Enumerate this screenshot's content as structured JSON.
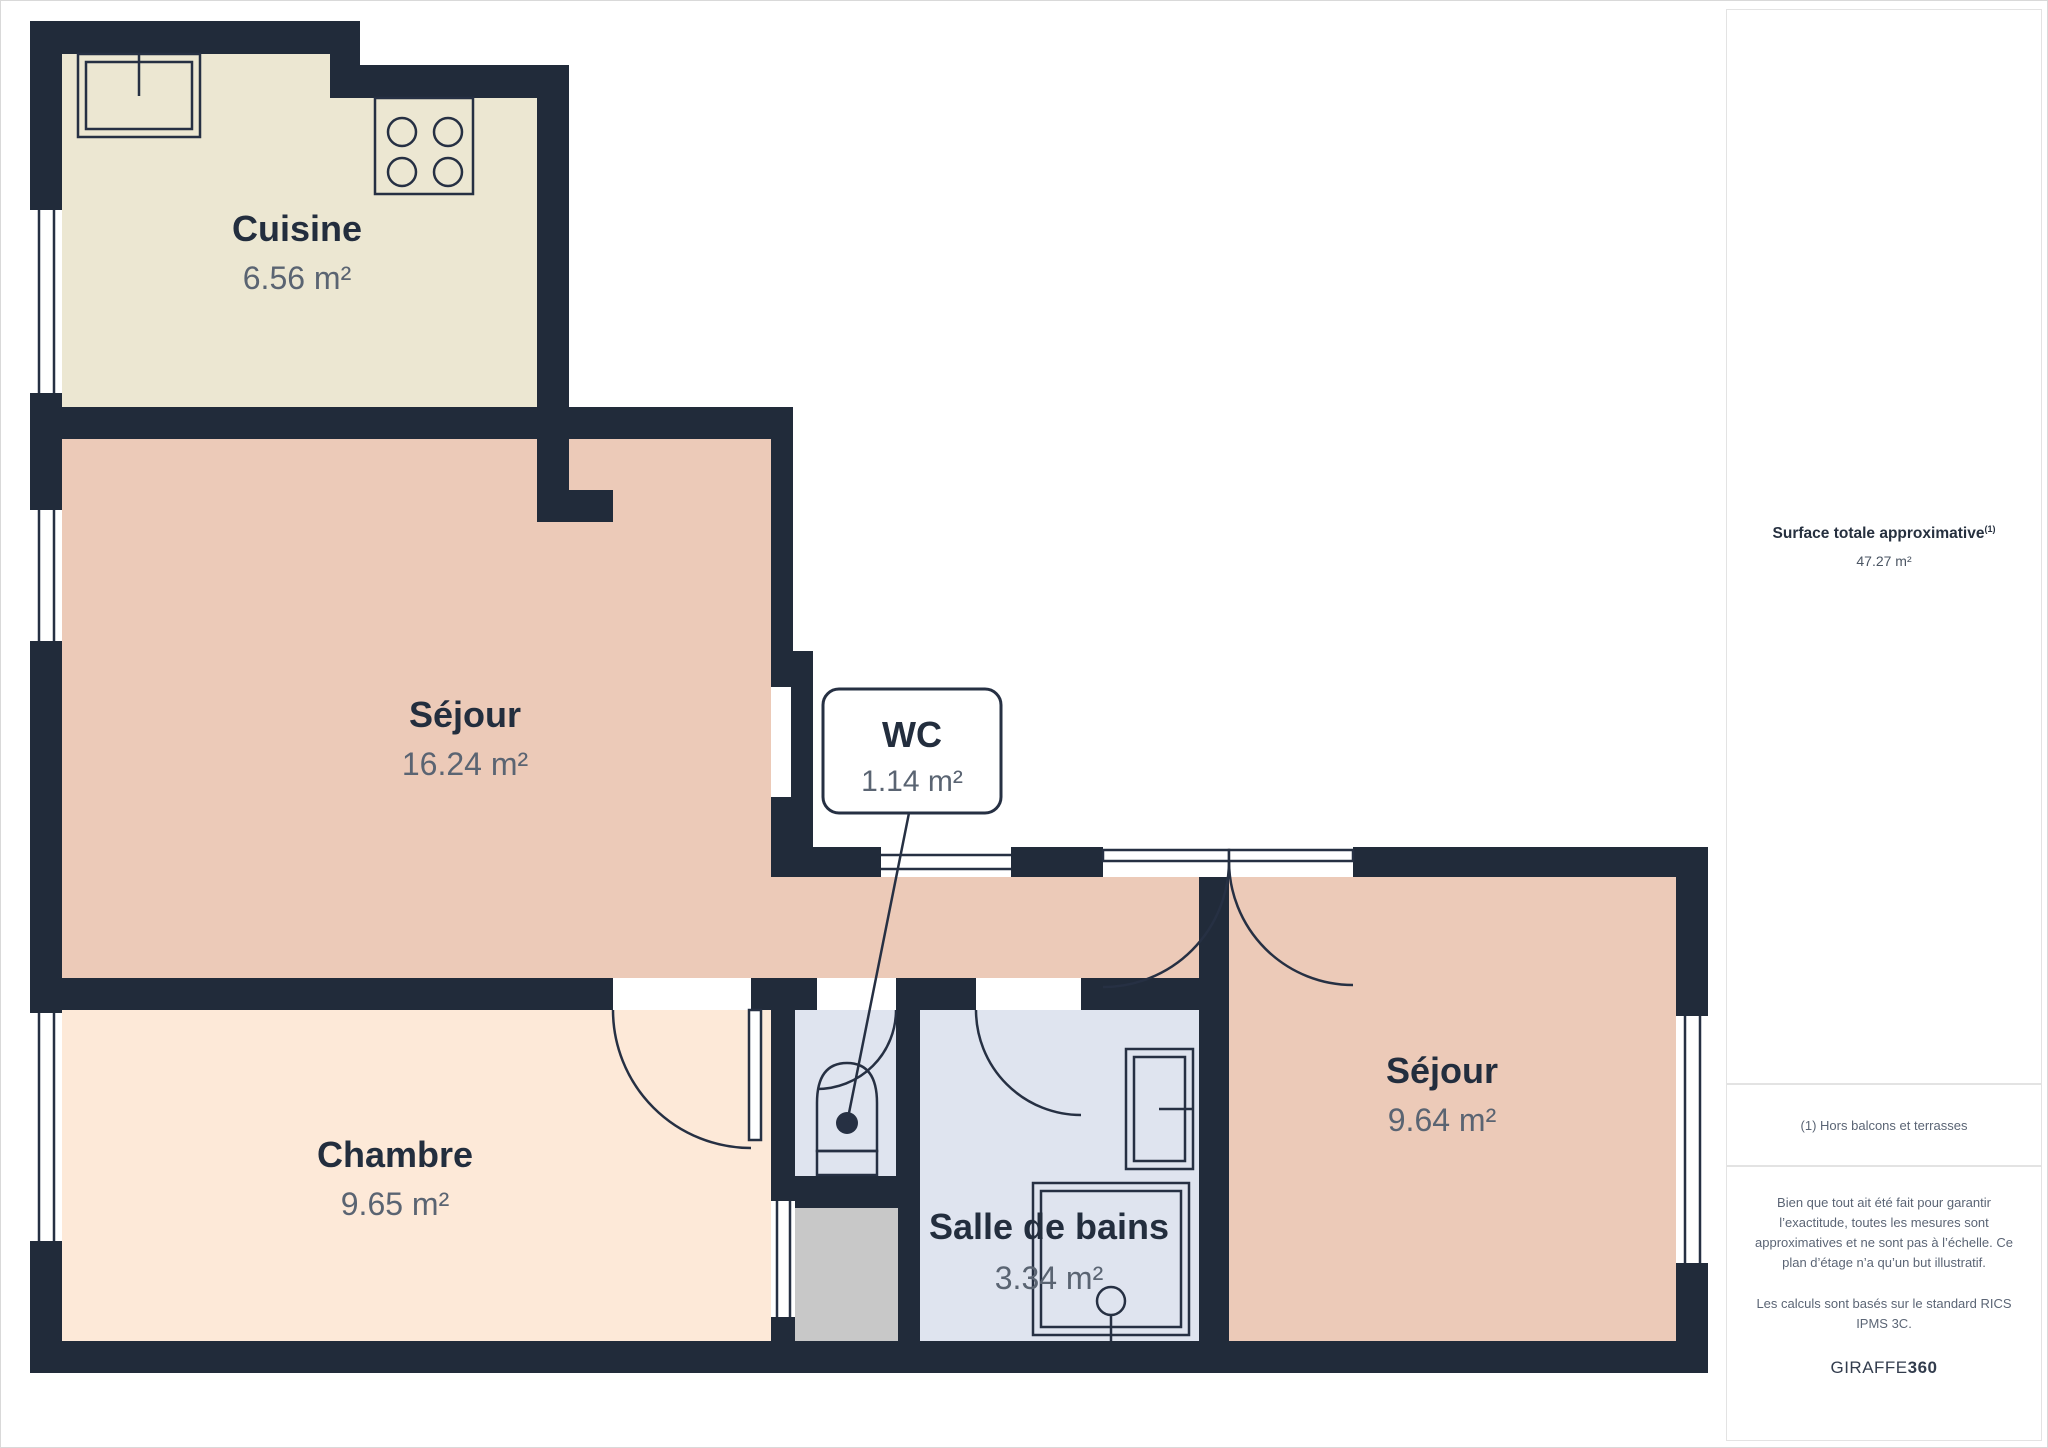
{
  "floorplan": {
    "rooms": [
      {
        "name": "Cuisine",
        "area": "6.56 m²",
        "color": "#ece7d2"
      },
      {
        "name": "Séjour",
        "area": "16.24 m²",
        "color": "#eccab8"
      },
      {
        "name": "WC",
        "area": "1.14 m²",
        "color": "#dfe4ef"
      },
      {
        "name": "Chambre",
        "area": "9.65 m²",
        "color": "#fde9d8"
      },
      {
        "name": "Salle de bains",
        "area": "3.34 m²",
        "color": "#dfe4ef"
      },
      {
        "name": "Séjour",
        "area": "9.64 m²",
        "color": "#eccab8"
      }
    ],
    "wall_color": "#212b3a",
    "vestibule_color": "#c8c8c8"
  },
  "sidebar": {
    "total_label": "Surface totale approximative",
    "total_marker": "(1)",
    "total_value": "47.27 m²",
    "footnote": "(1) Hors balcons et terrasses",
    "disclaimer1": "Bien que tout ait été fait pour garantir l’exactitude, toutes les mesures sont approximatives et ne sont pas à l’échelle. Ce plan d’étage n’a qu’un but illustratif.",
    "disclaimer2": "Les calculs sont basés sur le standard RICS IPMS 3C.",
    "brand_name": "GIRAFFE",
    "brand_suffix": "360"
  }
}
